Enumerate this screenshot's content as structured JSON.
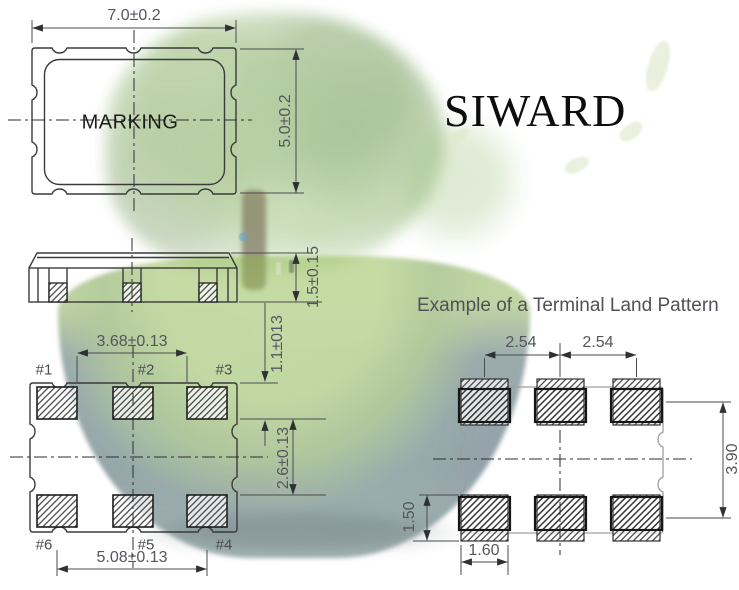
{
  "brand": {
    "logo": "SIWARD"
  },
  "top_view": {
    "marking": "MARKING",
    "dim_width": "7.0±0.2",
    "dim_height": "5.0±0.2"
  },
  "side_view": {
    "dim_height": "1.5±0.15"
  },
  "bottom_view": {
    "dim_pad_inner_span": "3.68±0.13",
    "dim_edge_to_pad": "1.1±013",
    "dim_row_gap": "2.6±0.13",
    "dim_pad_outer_span": "5.08±0.13",
    "pad_labels": [
      "#1",
      "#2",
      "#3",
      "#6",
      "#5",
      "#4"
    ]
  },
  "land_pattern": {
    "title": "Example of a Terminal Land Pattern",
    "dim_pitch_left": "2.54",
    "dim_pitch_right": "2.54",
    "dim_vertical_span": "3.90",
    "dim_pad_height": "1.50",
    "dim_pad_width": "1.60"
  },
  "colors": {
    "outline": "#3b3b3b",
    "dimension_line": "#4a4b51",
    "dimension_text": "#54565e",
    "land_outline": "#9aa0a0",
    "hatch": "#2d2d2d",
    "logo_text": "#0d0d0d",
    "title_text": "#515157"
  }
}
